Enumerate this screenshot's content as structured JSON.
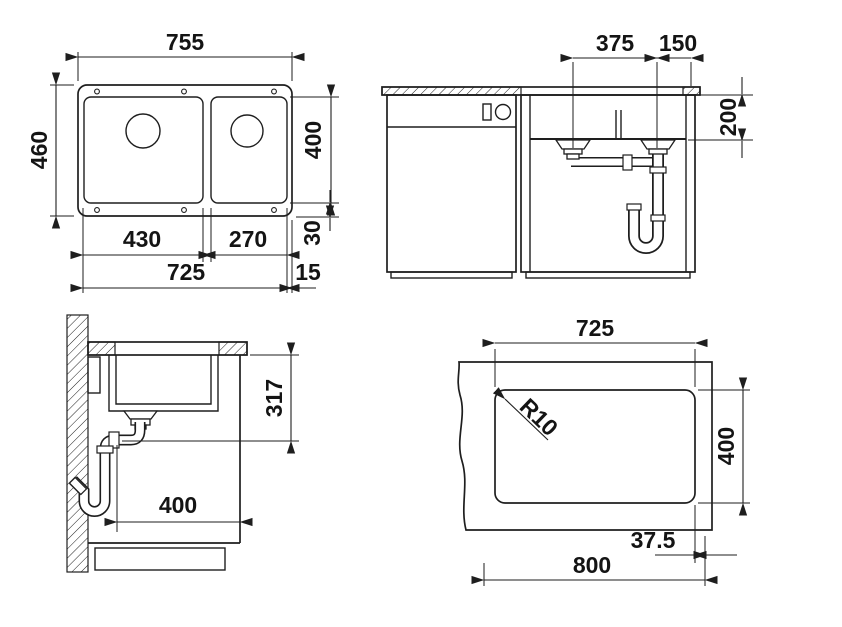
{
  "drawing": {
    "type": "technical-drawing",
    "background_color": "#ffffff",
    "line_color": "#1e1e1e",
    "views": {
      "top": {
        "label": "top-view",
        "dims": {
          "overall_width": "755",
          "overall_depth": "460",
          "bowl_depth": "400",
          "bottom_rim": "30",
          "left_bowl_width": "430",
          "right_bowl_width": "270",
          "inner_width": "725",
          "right_rim": "15"
        }
      },
      "front": {
        "label": "front-view",
        "dims": {
          "drain_spacing": "375",
          "drain_to_edge": "150",
          "bowl_height": "200"
        }
      },
      "side": {
        "label": "side-view",
        "dims": {
          "outlet_height": "317",
          "front_clearance": "400"
        }
      },
      "cutout": {
        "label": "cutout-template-view",
        "dims": {
          "cutout_width": "725",
          "cutout_depth": "400",
          "corner_radius": "R10",
          "edge_margin": "37.5",
          "min_width": "800"
        }
      }
    }
  }
}
